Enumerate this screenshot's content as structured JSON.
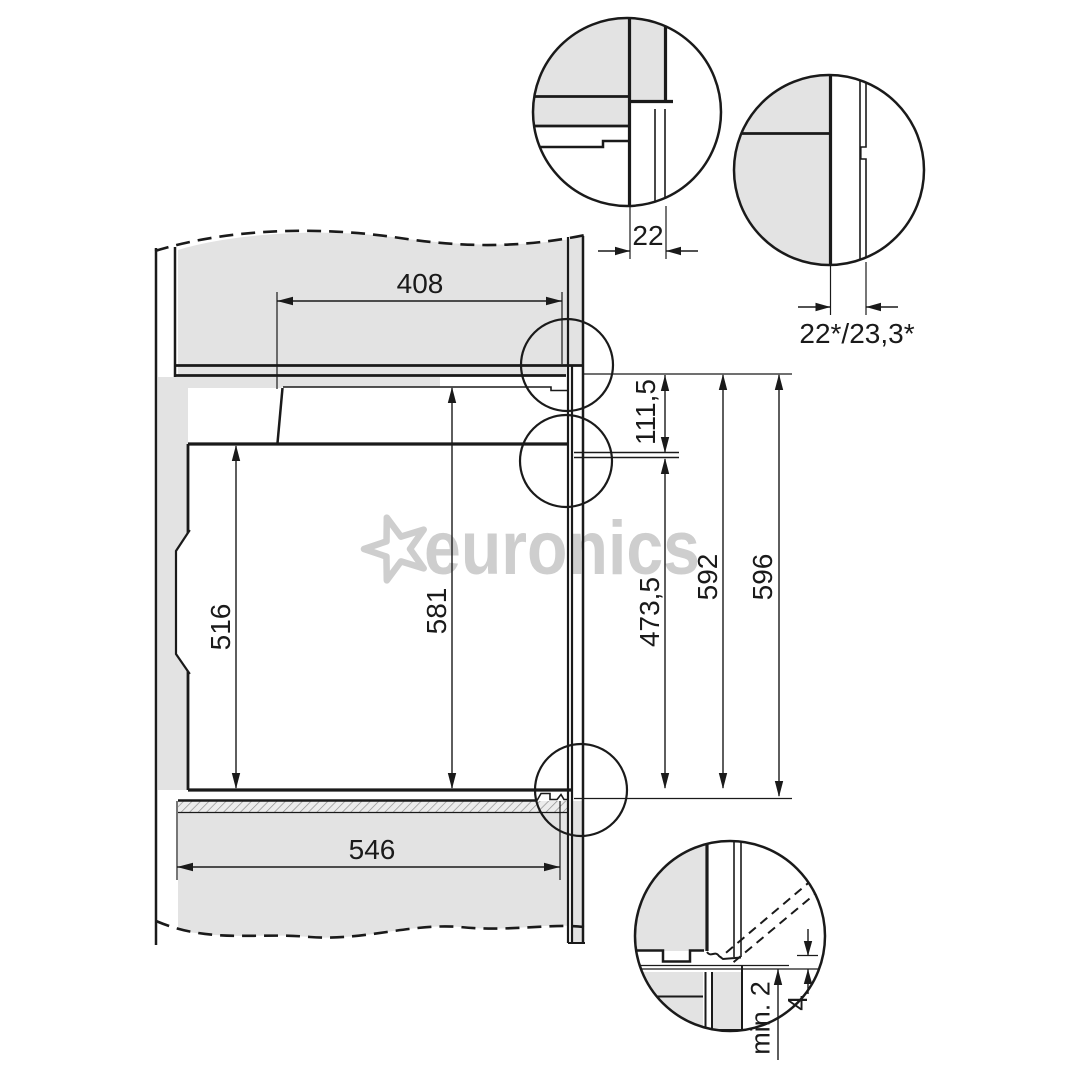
{
  "watermark": {
    "brand": "euronics",
    "star_icon": "star"
  },
  "main_dimensions": {
    "top_width": "408",
    "bottom_width": "546",
    "niche_height": "516",
    "front_height": "581",
    "top_offset": "111,5",
    "lower_front_height": "473,5",
    "body_height": "592",
    "total_height": "596"
  },
  "detail_dimensions": {
    "top_left_gap": "22",
    "top_right_gap": "22*/23,3*",
    "bottom_clearance": "min. 2",
    "bottom_offset": "4"
  },
  "colors": {
    "line": "#1a1a1a",
    "panel_fill": "#e3e3e3",
    "watermark": "#c8c8c8",
    "background": "#ffffff"
  }
}
